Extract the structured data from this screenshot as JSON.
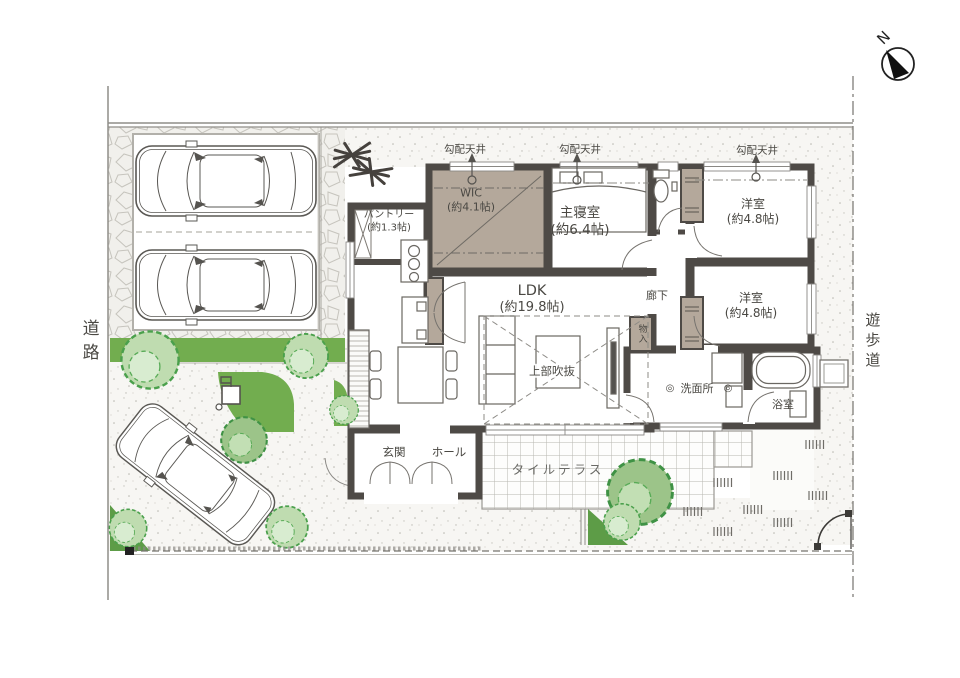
{
  "compass": {
    "north_label": "N"
  },
  "surroundings": {
    "road": "道路",
    "walkway": "遊歩道"
  },
  "ceiling_note": {
    "label": "勾配天井"
  },
  "rooms": {
    "pantry": {
      "name": "パントリー",
      "size": "(約1.3帖)"
    },
    "wic": {
      "name": "WIC",
      "size": "(約4.1帖)"
    },
    "master_bedroom": {
      "name": "主寝室",
      "size": "(約6.4帖)"
    },
    "western_room_1": {
      "name": "洋室",
      "size": "(約4.8帖)"
    },
    "western_room_2": {
      "name": "洋室",
      "size": "(約4.8帖)"
    },
    "ldk": {
      "name": "LDK",
      "size": "(約19.8帖)"
    },
    "void_above": {
      "name": "上部吹抜"
    },
    "corridor": {
      "name": "廊下"
    },
    "storage": {
      "name": "物入"
    },
    "washroom": {
      "name": "洗面所",
      "symbol": "◎"
    },
    "bathroom": {
      "name": "浴室"
    },
    "entrance": {
      "name": "玄関"
    },
    "hall": {
      "name": "ホール"
    },
    "tile_terrace": {
      "name": "タイルテラス"
    }
  },
  "colors": {
    "wall": "#4e4a46",
    "closet_tan": "#b4a89b",
    "step_tan": "#cbbcab",
    "green": "#72ad4f",
    "bush_fill": "#bfdcb0",
    "bush_stroke": "#4aa04c"
  }
}
